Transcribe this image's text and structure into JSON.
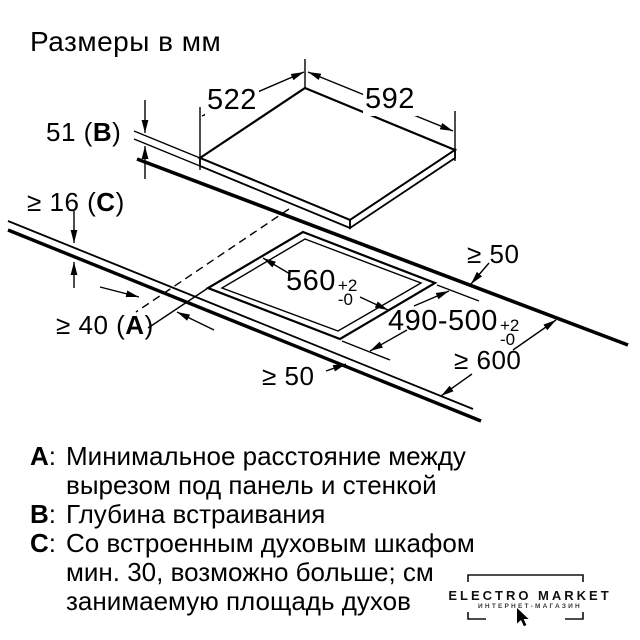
{
  "title": "Размеры в мм",
  "diagram": {
    "dim_top_left": "522",
    "dim_top_right": "592",
    "dim_b": {
      "prefix": "51 (",
      "letter": "B",
      "suffix": ")"
    },
    "dim_c": {
      "prefix": "≥ 16 (",
      "letter": "C",
      "suffix": ")"
    },
    "dim_a": {
      "prefix": "≥ 40 (",
      "letter": "A",
      "suffix": ")"
    },
    "dim_cutout_width": {
      "value": "560",
      "tol_plus": "+2",
      "tol_minus": "-0"
    },
    "dim_cutout_depth": {
      "value": "490-500",
      "tol_plus": "+2",
      "tol_minus": "-0"
    },
    "dim_clearance_back": "≥ 50",
    "dim_clearance_front": "≥ 50",
    "dim_worktop_depth": "≥ 600"
  },
  "legend": {
    "items": [
      {
        "letter": "A",
        "sep": ":",
        "lines": [
          "Минимальное расстояние между",
          "вырезом под панель и стенкой"
        ]
      },
      {
        "letter": "B",
        "sep": ":",
        "lines": [
          "Глубина встраивания"
        ]
      },
      {
        "letter": "C",
        "sep": ":",
        "lines": [
          "Со встроенным духовым шкафом",
          "мин. 30, возможно больше; см",
          "занимаемую площадь духов"
        ]
      }
    ]
  },
  "watermark": {
    "name": "ELECTRO MARKET",
    "subtitle": "ИНТЕРНЕТ-МАГАЗИН"
  }
}
